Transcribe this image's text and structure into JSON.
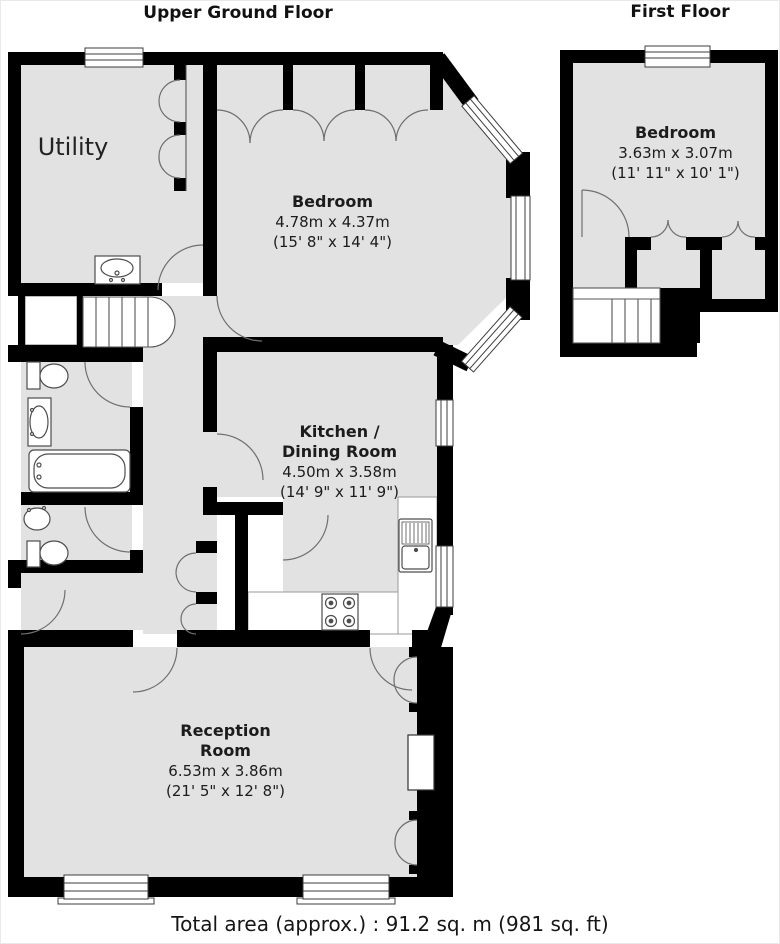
{
  "floors": {
    "upper": {
      "title": "Upper Ground Floor"
    },
    "first": {
      "title": "First Floor"
    }
  },
  "rooms": {
    "utility": {
      "name": "Utility"
    },
    "bedroom_ground": {
      "name": "Bedroom",
      "size_metric": "4.78m x 4.37m",
      "size_imperial": "(15' 8\" x 14' 4\")"
    },
    "kitchen_dining": {
      "name_line1": "Kitchen /",
      "name_line2": "Dining Room",
      "size_metric": "4.50m x 3.58m",
      "size_imperial": "(14' 9\" x 11' 9\")"
    },
    "reception": {
      "name_line1": "Reception",
      "name_line2": "Room",
      "size_metric": "6.53m x 3.86m",
      "size_imperial": "(21' 5\" x 12' 8\")"
    },
    "bedroom_first": {
      "name": "Bedroom",
      "size_metric": "3.63m x 3.07m",
      "size_imperial": "(11' 11\" x 10' 1\")"
    }
  },
  "footer": {
    "total_area": "Total area (approx.) : 91.2 sq. m (981 sq. ft)"
  },
  "colors": {
    "wall": "#000000",
    "room_fill": "#e2e2e2",
    "detail_line": "#6f6f6f",
    "text": "#1c1c1c"
  }
}
